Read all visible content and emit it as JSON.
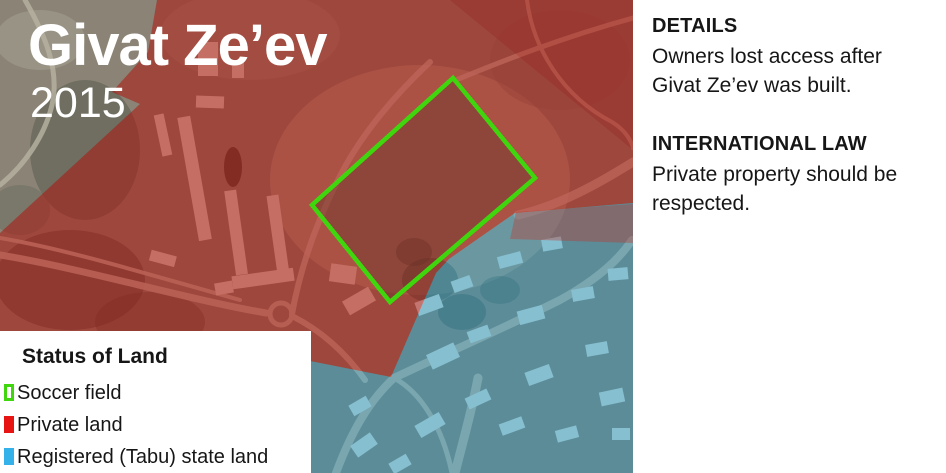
{
  "header": {
    "title": "Givat Ze’ev",
    "year": "2015"
  },
  "legend": {
    "title": "Status of Land",
    "items": [
      {
        "label": "Soccer field",
        "swatch": "green-outline"
      },
      {
        "label": "Private land",
        "swatch": "red-solid"
      },
      {
        "label": "Registered (Tabu) state land",
        "swatch": "blue-solid"
      }
    ]
  },
  "info_panel": {
    "sections": [
      {
        "heading": "DETAILS",
        "body": "Owners lost access after Givat Ze’ev was built."
      },
      {
        "heading": "INTERNATIONAL LAW",
        "body": "Private property should be respected."
      }
    ]
  },
  "map": {
    "type": "satellite-with-overlays",
    "regions": [
      {
        "name": "soccer-field-outline",
        "meaning": "Soccer field"
      },
      {
        "name": "private-land-overlay",
        "meaning": "Private land"
      },
      {
        "name": "state-land-overlay",
        "meaning": "Registered (Tabu) state land"
      },
      {
        "name": "unshaded-satellite",
        "meaning": "unclassified area"
      }
    ]
  },
  "colors": {
    "soccer_field_green": "#3fd60e",
    "private_land_red": "#e81414",
    "state_land_blue": "#33b1e8",
    "private_land_overlay": "rgba(173,22,14,0.55)",
    "state_land_overlay": "rgba(45,150,185,0.50)",
    "panel_background": "#ffffff",
    "title_color": "#ffffff",
    "text_color": "#161616"
  }
}
